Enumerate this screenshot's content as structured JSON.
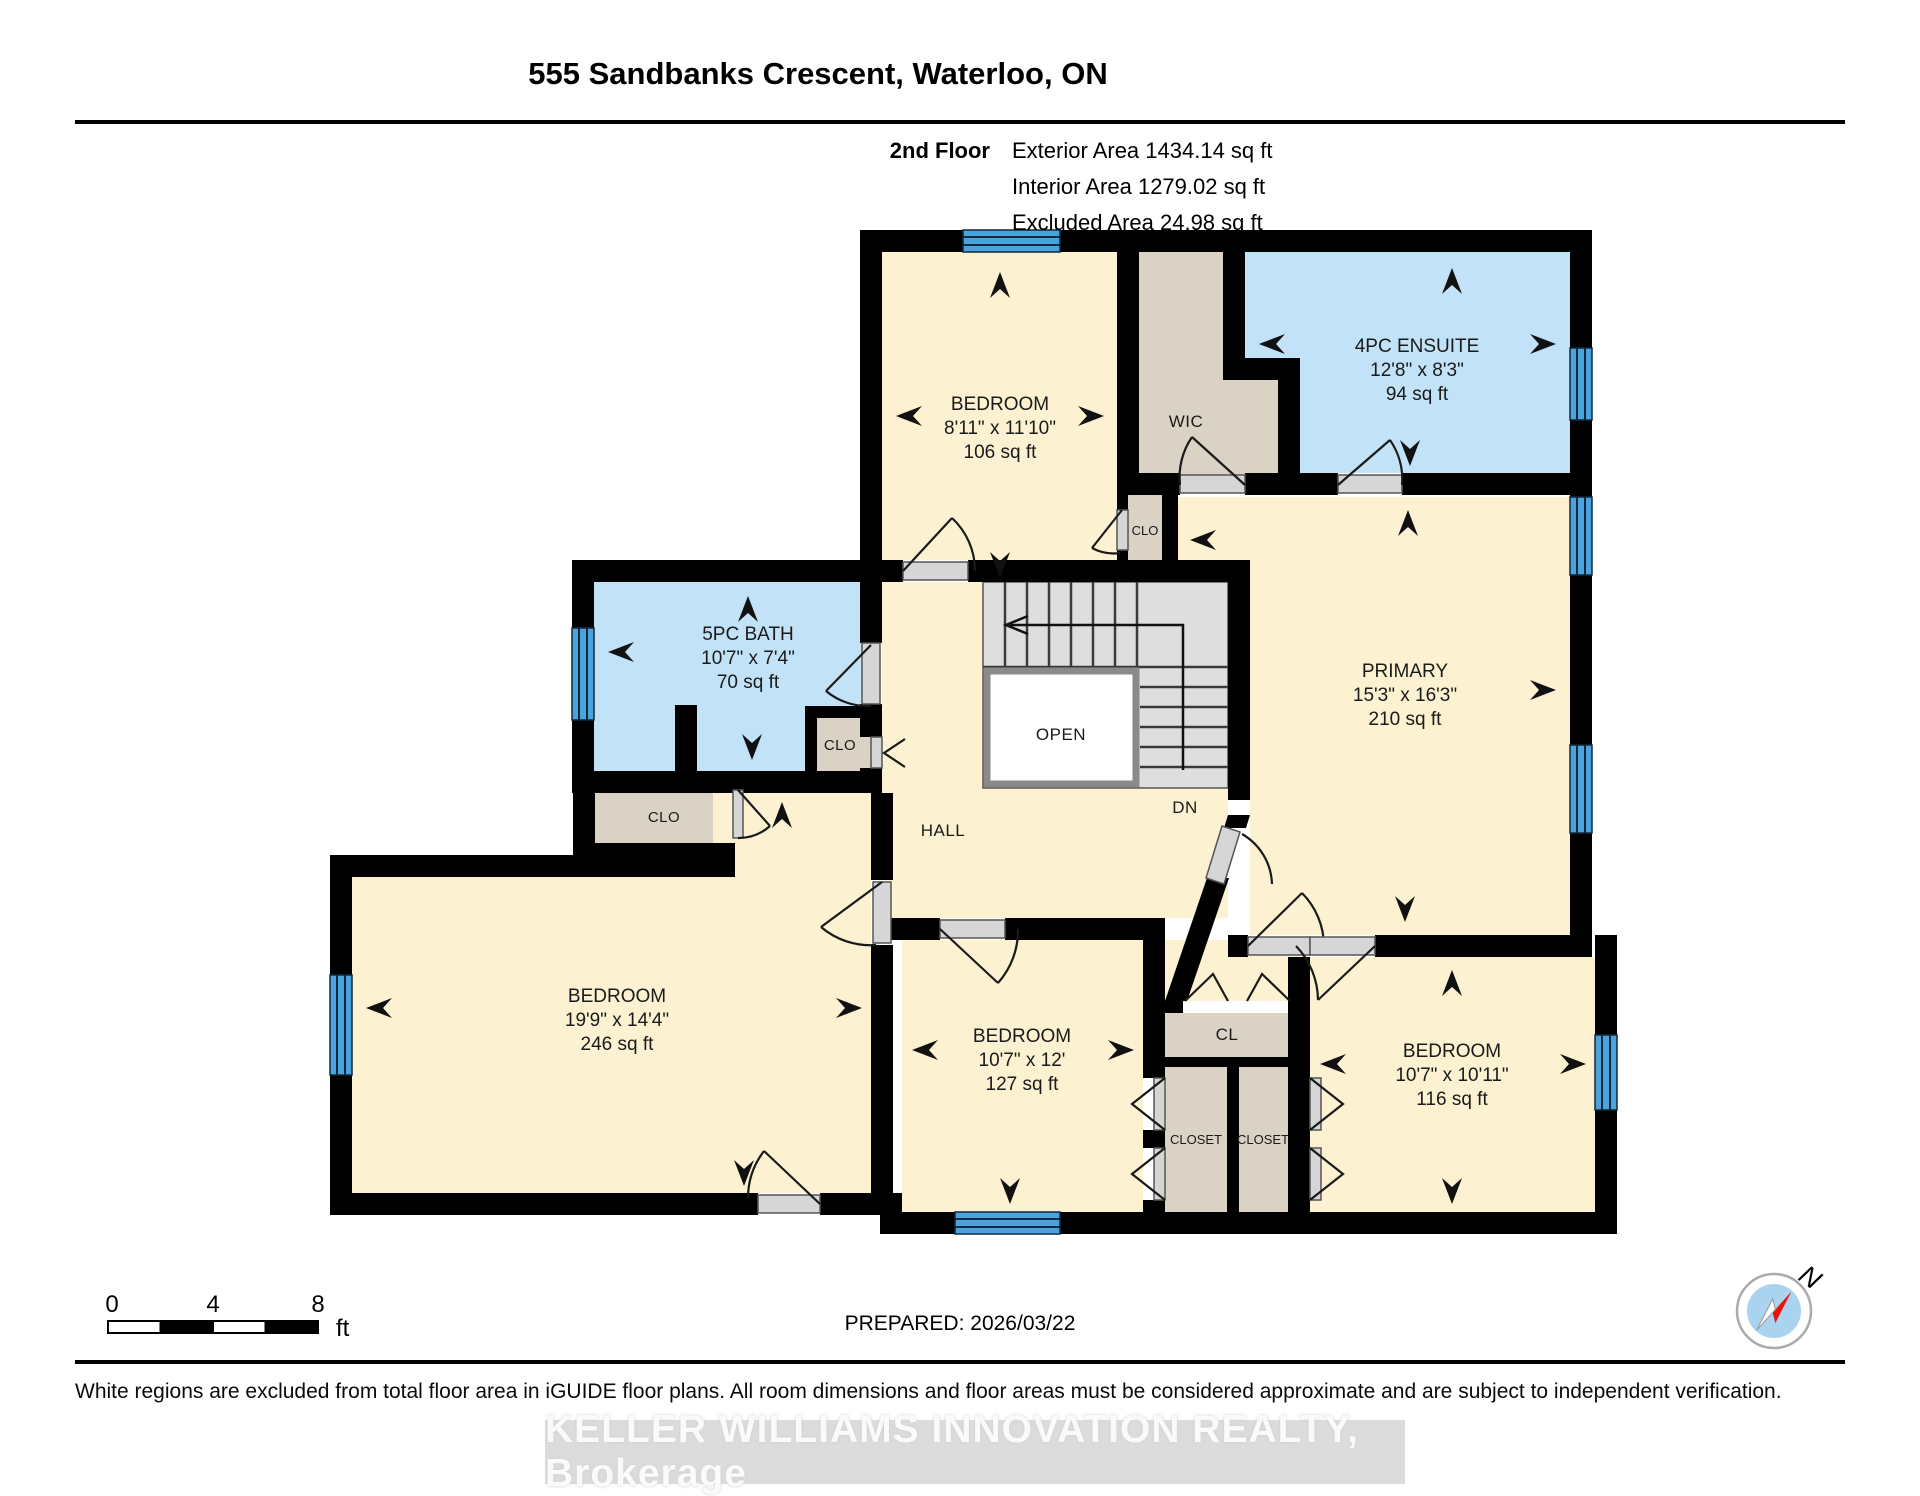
{
  "header": {
    "title": "555 Sandbanks Crescent, Waterloo, ON",
    "floor_label": "2nd Floor",
    "exterior_area": "Exterior Area 1434.14 sq ft",
    "interior_area": "Interior Area 1279.02 sq ft",
    "excluded_area": "Excluded Area 24.98 sq ft"
  },
  "plan": {
    "rooms": {
      "bedroom_top": {
        "name": "BEDROOM",
        "dims": "8'11\" x 11'10\"",
        "area": "106 sq ft"
      },
      "wic": {
        "name": "WIC"
      },
      "ensuite": {
        "name": "4PC ENSUITE",
        "dims": "12'8\" x 8'3\"",
        "area": "94 sq ft"
      },
      "primary": {
        "name": "PRIMARY",
        "dims": "15'3\" x 16'3\"",
        "area": "210 sq ft"
      },
      "bath": {
        "name": "5PC BATH",
        "dims": "10'7\" x 7'4\"",
        "area": "70 sq ft"
      },
      "bedroom_left": {
        "name": "BEDROOM",
        "dims": "19'9\" x 14'4\"",
        "area": "246 sq ft"
      },
      "bedroom_middle": {
        "name": "BEDROOM",
        "dims": "10'7\" x 12'",
        "area": "127 sq ft"
      },
      "bedroom_right": {
        "name": "BEDROOM",
        "dims": "10'7\" x 10'11\"",
        "area": "116 sq ft"
      }
    },
    "labels": {
      "clo_bed": "CLO",
      "clo_bath": "CLO",
      "clo_hall": "CLO",
      "hall": "HALL",
      "open": "OPEN",
      "dn": "DN",
      "cl": "CL",
      "closet1": "CLOSET",
      "closet2": "CLOSET"
    },
    "colors": {
      "room": "#FCF1D1",
      "wet_room": "#C2E2F7",
      "closet": "#DAD2C4",
      "window": "#4BA3DE",
      "wall": "#000000",
      "compass_needle": "#e8130c"
    }
  },
  "footer": {
    "scale": {
      "t0": "0",
      "t4": "4",
      "t8": "8",
      "unit": "ft"
    },
    "prepared": "PREPARED: 2026/03/22",
    "compass_n": "N",
    "disclaimer": "White regions are excluded from total floor area in iGUIDE floor plans. All room dimensions and floor areas must be considered approximate and are subject to independent verification.",
    "brokerage": "KELLER WILLIAMS INNOVATION REALTY, Brokerage"
  }
}
